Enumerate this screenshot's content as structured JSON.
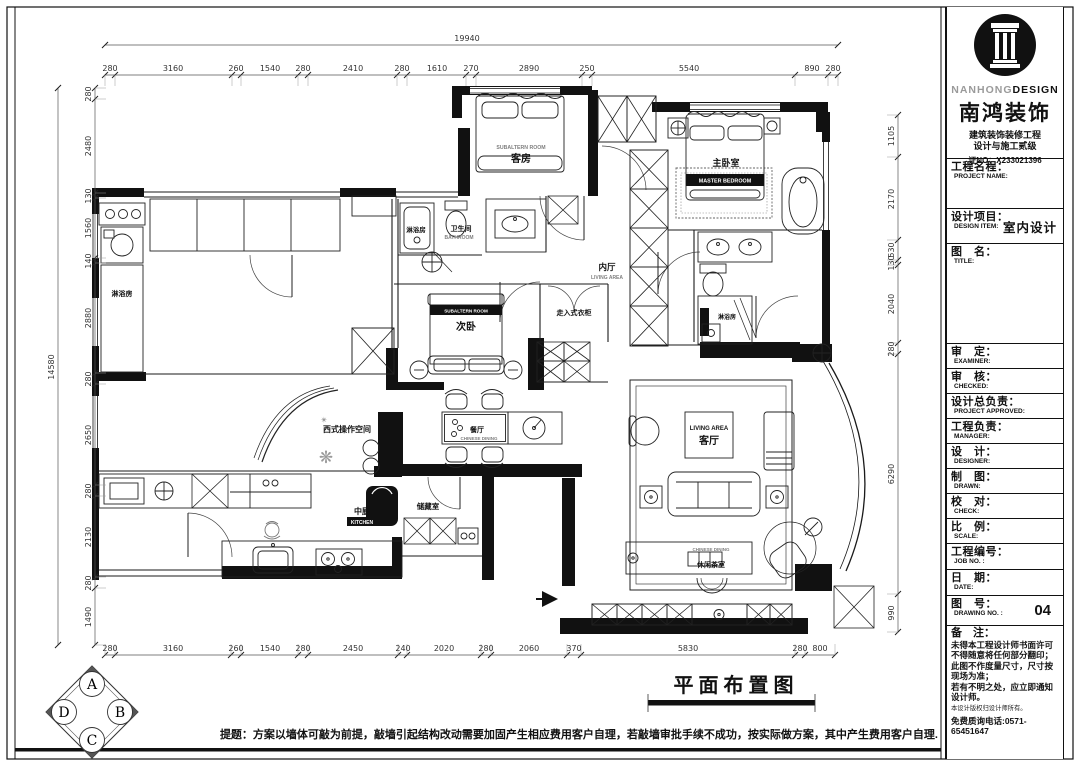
{
  "title_block": {
    "logo": {
      "brand_en_light": "NANHONG",
      "brand_en_bold": "DESIGN",
      "brand_cn": "南鸿装饰",
      "cert_line1": "建筑装饰装修工程",
      "cert_line2": "设计与施工贰级",
      "cert_no": "证NO：X233021396"
    },
    "fields": [
      {
        "cn": "工程名程：",
        "en": "PROJECT NAME:",
        "value": ""
      },
      {
        "cn": "设计项目：",
        "en": "DESIGN ITEM:",
        "value": "室内设计"
      },
      {
        "cn": "图　名：",
        "en": "TITLE:",
        "value": ""
      },
      {
        "cn": "审　定：",
        "en": "EXAMINER:",
        "value": ""
      },
      {
        "cn": "审　核：",
        "en": "CHECKED:",
        "value": ""
      },
      {
        "cn": "设计总负责：",
        "en": "PROJECT APPROVED:",
        "value": ""
      },
      {
        "cn": "工程负责：",
        "en": "MANAGER:",
        "value": ""
      },
      {
        "cn": "设　计：",
        "en": "DESIGNER:",
        "value": ""
      },
      {
        "cn": "制　图：",
        "en": "DRAWN:",
        "value": ""
      },
      {
        "cn": "校　对：",
        "en": "CHECK:",
        "value": ""
      },
      {
        "cn": "比　例：",
        "en": "SCALE:",
        "value": ""
      },
      {
        "cn": "工程编号：",
        "en": "JOB  NO. :",
        "value": ""
      },
      {
        "cn": "日　期：",
        "en": "DATE:",
        "value": ""
      },
      {
        "cn": "图　号：",
        "en": "DRAWING NO. :",
        "value": "04"
      }
    ],
    "remarks": {
      "label": "备　注：",
      "lines": [
        "未得本工程设计师书面许可不得随意将任何部分翻印；",
        "此图不作度量尺寸，尺寸按现场为准；",
        "若有不明之处，应立即通知设计师。"
      ],
      "fine_print": "本设计版权归设计师所有。",
      "hotline": "免费质询电话:0571-65451647"
    }
  },
  "drawing": {
    "title": "平面布置图"
  },
  "note": "提题：方案以墙体可敲为前提，敲墙引起结构改动需要加固产生相应费用客户自理，若敲墙审批手续不成功，按实际做方案，其中产生费用客户自理.",
  "compass": {
    "top": "A",
    "right": "B",
    "bottom": "C",
    "left": "D"
  },
  "rooms": {
    "guest": {
      "cn": "客房",
      "en": "SUBALTERN ROOM"
    },
    "master": {
      "cn": "主卧室",
      "en": "MASTER BEDROOM"
    },
    "shower_left": {
      "cn": "淋浴房"
    },
    "bath_shower": {
      "cn": "淋浴房"
    },
    "bathroom": {
      "cn": "卫生间",
      "en": "BATHROOM"
    },
    "inner_hall": {
      "cn": "内厅",
      "en": "LIVING AREA"
    },
    "second_bedroom": {
      "cn": "次卧",
      "en": "SUBALTERN ROOM"
    },
    "walkin_closet": {
      "cn": "走入式衣柜"
    },
    "master_shower": {
      "cn": "淋浴房"
    },
    "western_kitchen": {
      "cn": "西式操作空间"
    },
    "dining": {
      "cn": "餐厅",
      "en": "CHINESE DINING"
    },
    "living": {
      "cn": "客厅",
      "en": "LIVING AREA"
    },
    "kitchen": {
      "cn": "中厨",
      "en": "KITCHEN"
    },
    "storage": {
      "cn": "储藏室"
    },
    "tea_room": {
      "cn": "休闲茶室",
      "en": "CHINESE DINING"
    }
  },
  "deco": {
    "flower_large": "❋",
    "flower_small": "✴"
  },
  "dims": {
    "overall_top": "19940",
    "overall_left": "14580",
    "top": [
      "280",
      "3160",
      "260",
      "1540",
      "280",
      "2410",
      "280",
      "1610",
      "270",
      "2890",
      "250",
      "5540",
      "890",
      "280"
    ],
    "bottom": [
      "280",
      "3160",
      "260",
      "1540",
      "280",
      "2450",
      "240",
      "2020",
      "280",
      "2060",
      "370",
      "5830",
      "280",
      "800"
    ],
    "left": [
      "280",
      "2480",
      "130",
      "1560",
      "140",
      "2880",
      "280",
      "2650",
      "280",
      "2130",
      "280",
      "1490"
    ],
    "right": [
      "1105",
      "2170",
      "530",
      "130",
      "2040",
      "280",
      "6290",
      "990"
    ]
  }
}
